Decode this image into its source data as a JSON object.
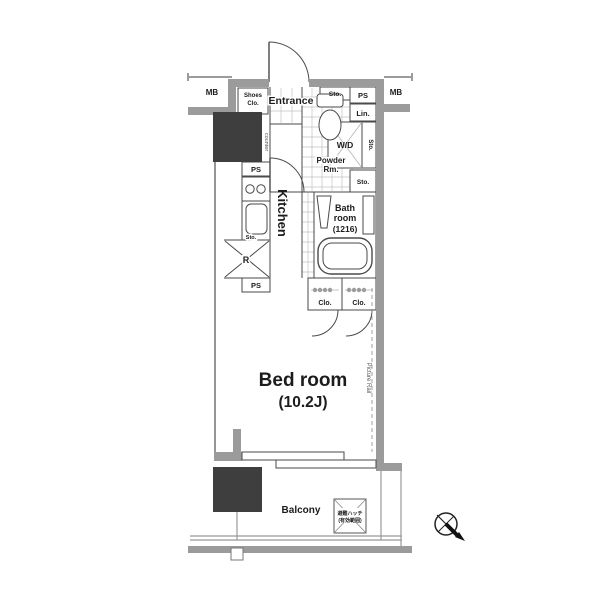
{
  "floor_plan": {
    "meters": {
      "mb_left": "MB",
      "mb_right": "MB"
    },
    "entrance": {
      "label": "Entrance",
      "shoes_closet_line1": "Shoes",
      "shoes_closet_line2": "Clo."
    },
    "utility": {
      "storage_top": "Sto.",
      "pipe_space_top_right": "PS",
      "linen": "Lin.",
      "washer_dryer": "W/D",
      "storage_side_vertical": "Sto.",
      "storage_right": "Sto.",
      "powder_room_line1": "Powder",
      "powder_room_line2": "Rm."
    },
    "kitchen": {
      "label": "Kitchen",
      "counter": "counter",
      "pipe_space_top": "PS",
      "storage_sink": "Sto.",
      "refrigerator": "R",
      "pipe_space_bottom": "PS"
    },
    "bathroom": {
      "line1": "Bath",
      "line2": "room",
      "line3": "(1216)"
    },
    "closets": {
      "left": "Clo.",
      "right": "Clo."
    },
    "bedroom": {
      "name": "Bed room",
      "size": "(10.2J)",
      "picture_rail": "Picture Rail"
    },
    "balcony": {
      "label": "Balcony",
      "hatch_line1": "避難ハッチ",
      "hatch_line2": "(有効範囲)"
    },
    "colors": {
      "wall": "#9b9b9b",
      "shaft": "#3e3e3e",
      "outline": "#4a4a4a",
      "grid": "#c2c2c2",
      "text": "#1c1c1c"
    }
  }
}
